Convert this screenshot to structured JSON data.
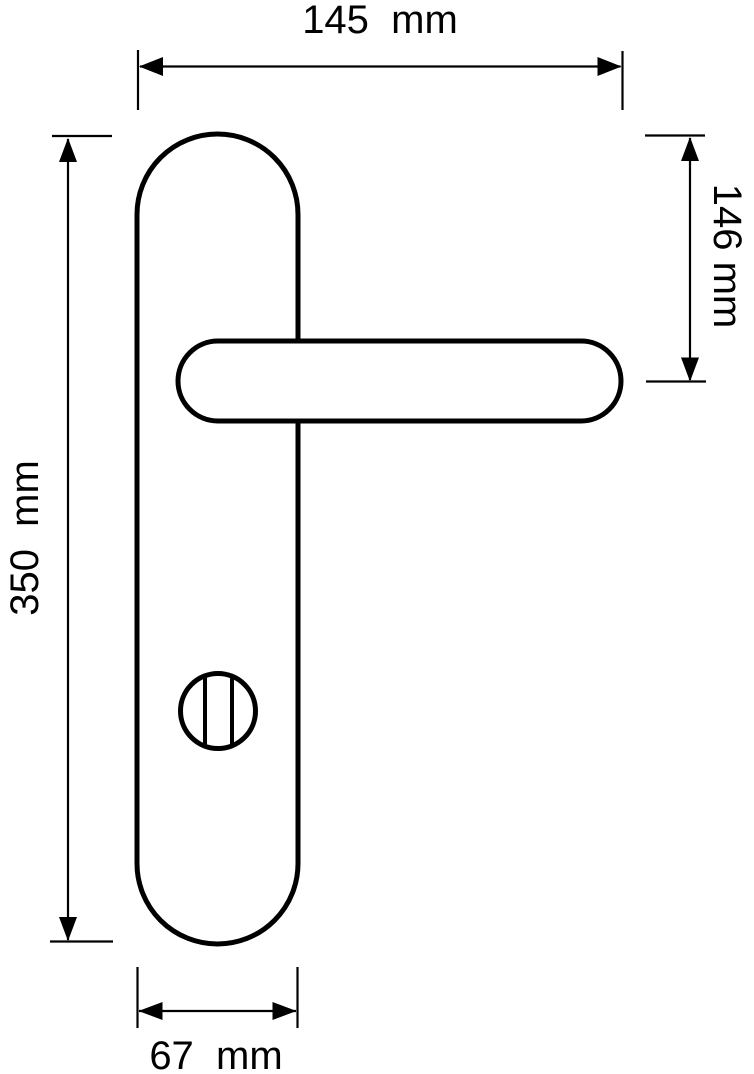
{
  "page": {
    "background": "#ffffff",
    "line_color": "#000000"
  },
  "drawing": {
    "subject": "door-handle-with-backplate-technical-drawing",
    "labels": {
      "overall_width": "145  mm",
      "plate_top_to_handle_center": "146 mm",
      "plate_height": "350  mm",
      "plate_width": "67  mm"
    }
  }
}
